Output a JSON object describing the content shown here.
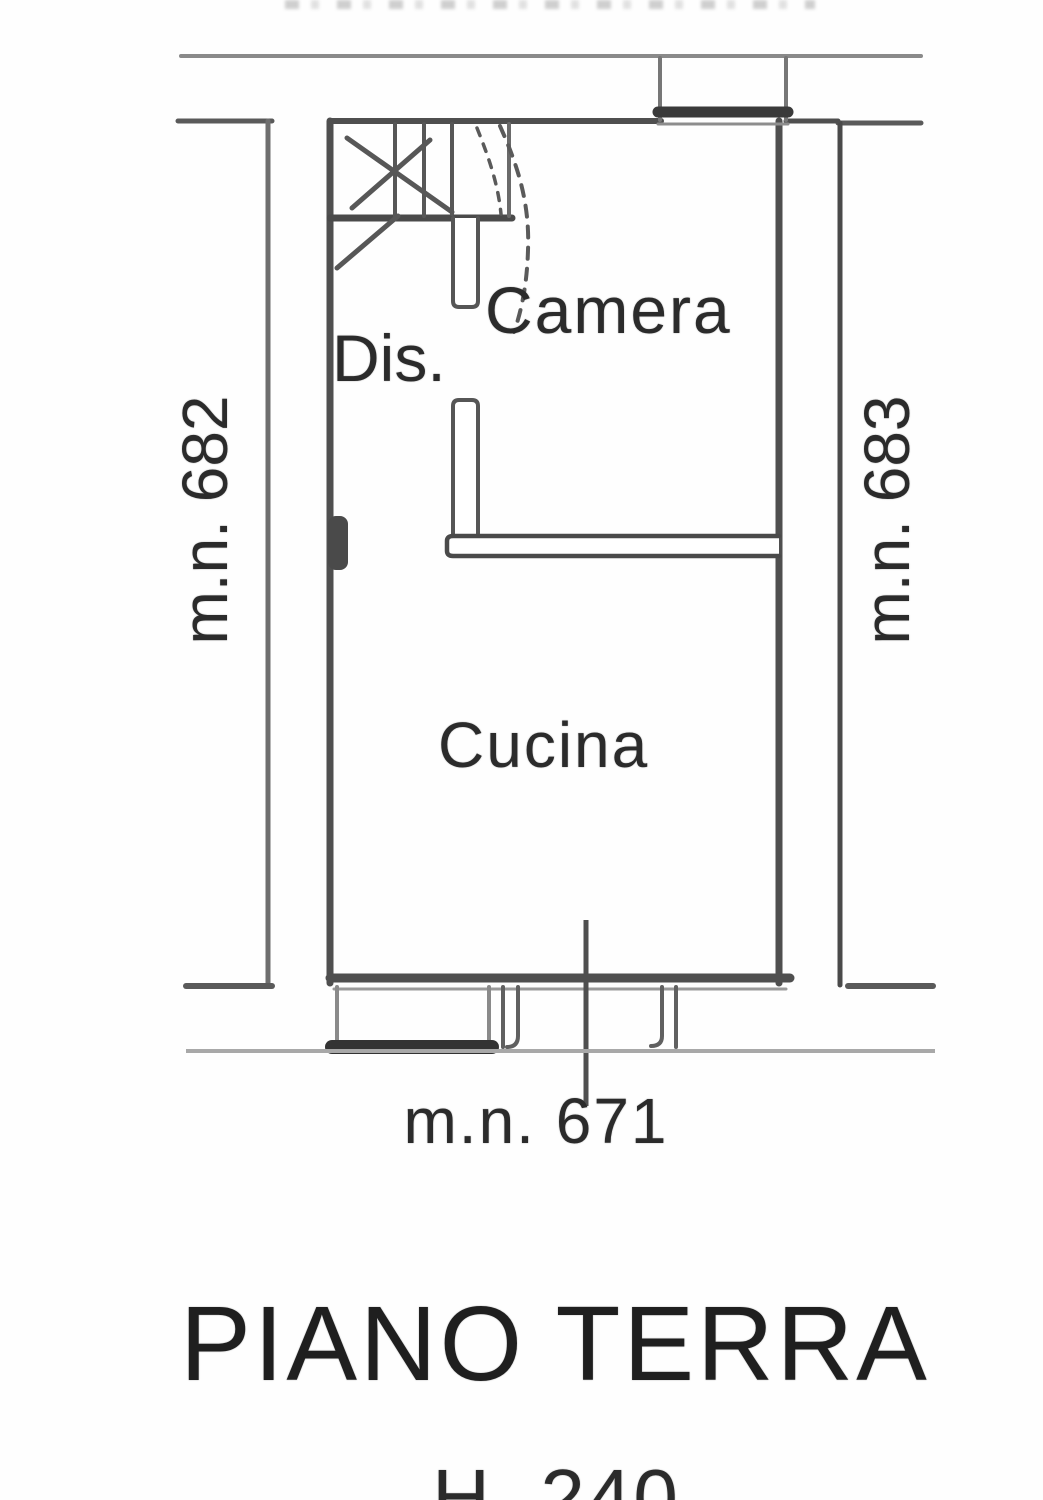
{
  "plan": {
    "rooms": [
      {
        "label": "Camera"
      },
      {
        "label": "Dis."
      },
      {
        "label": "Cucina"
      }
    ],
    "parcels": {
      "left": "m.n. 682",
      "right": "m.n. 683",
      "bottom": "m.n. 671"
    },
    "title": "PIANO TERRA",
    "height_note": "H. 240",
    "colors": {
      "wall_dark": "#4f4f4f",
      "wall_mid": "#6e6e6e",
      "boundary_light": "#a8a8a8",
      "text": "#2b2b2b"
    }
  }
}
